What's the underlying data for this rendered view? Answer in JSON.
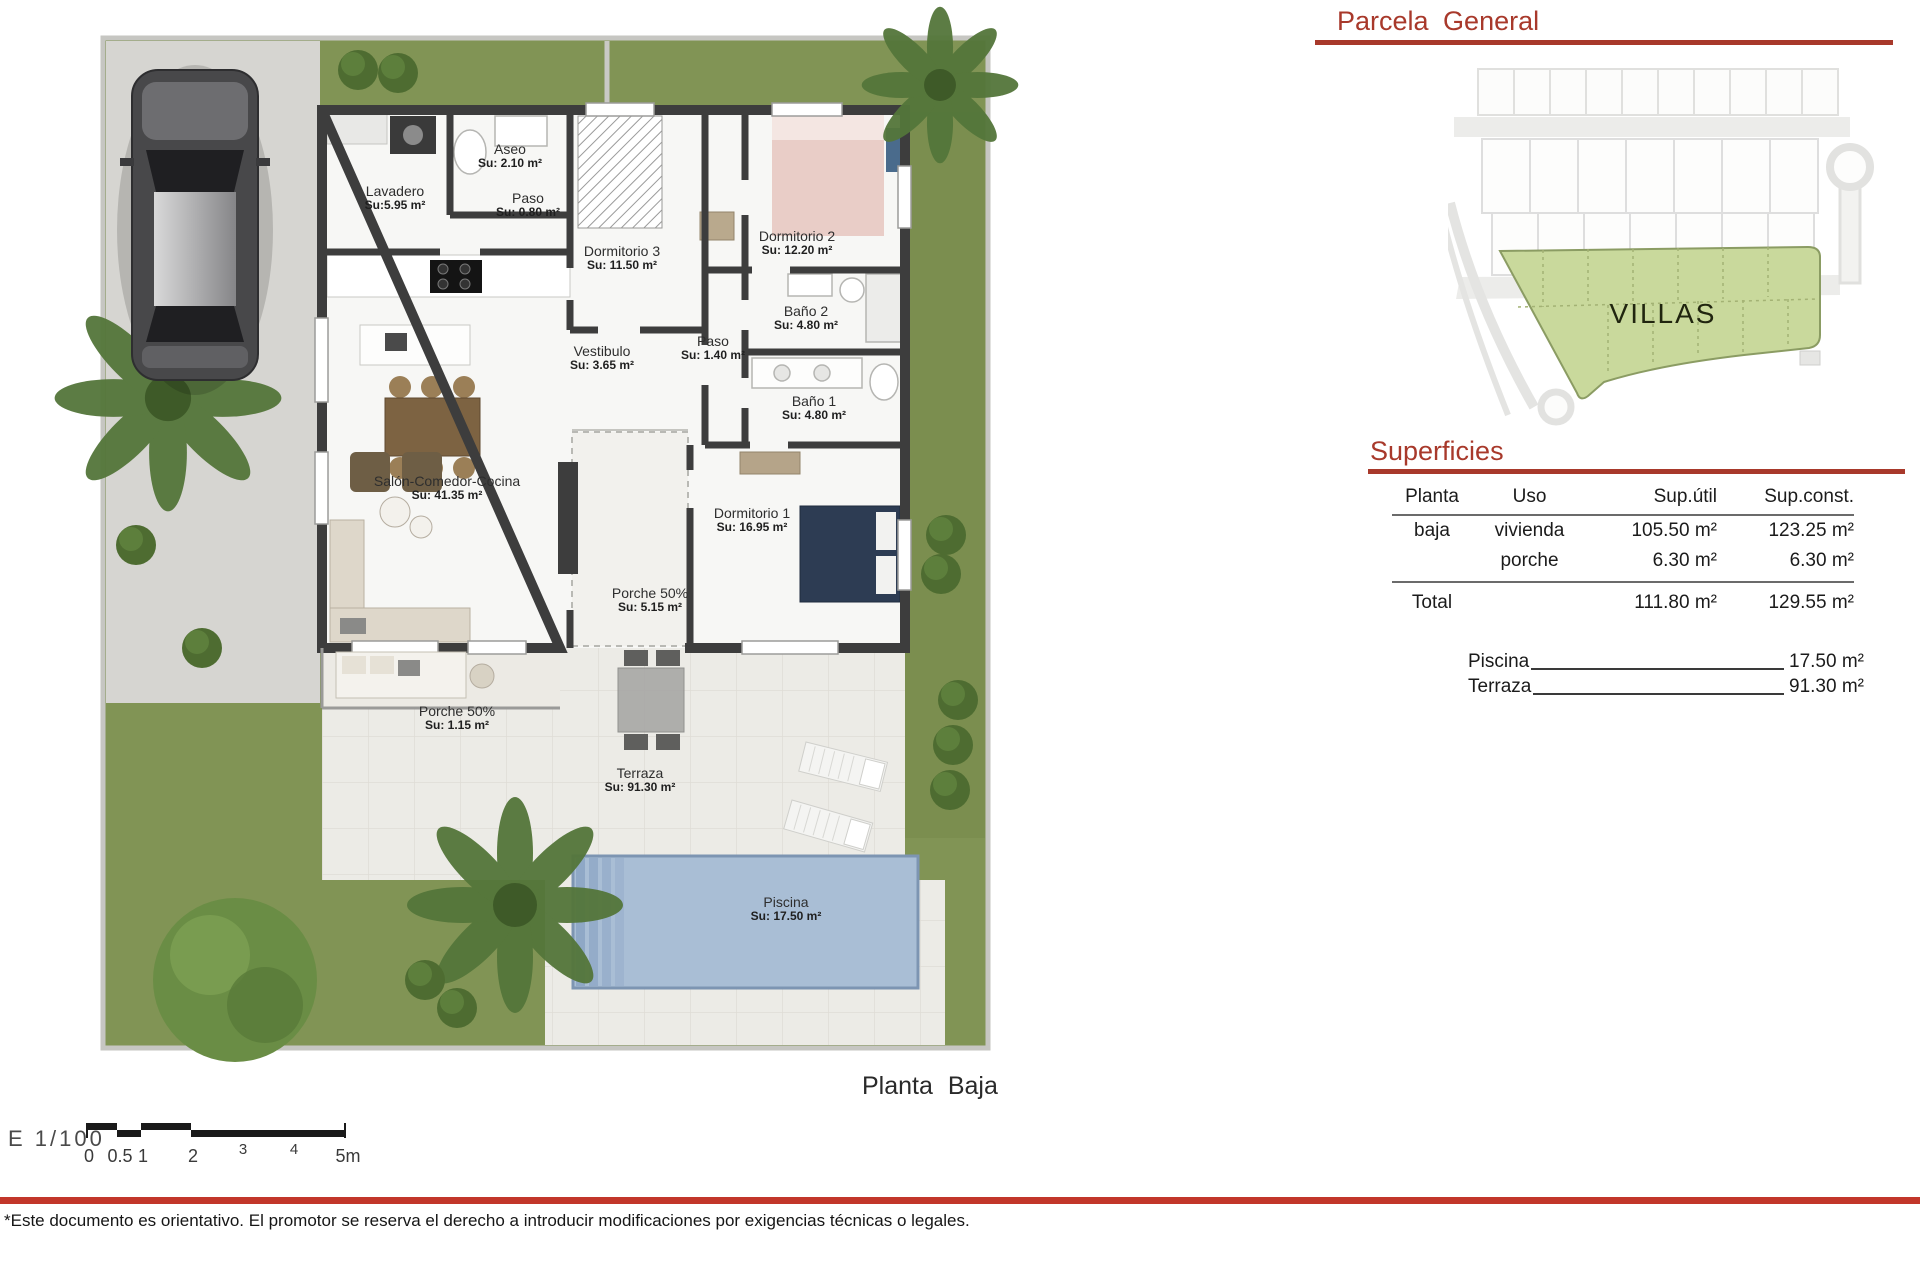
{
  "header": {
    "parcela_title": "Parcela General"
  },
  "siteplan": {
    "villas_label": "VILLAS"
  },
  "superficies": {
    "title": "Superficies",
    "table": {
      "col_planta": "Planta",
      "col_uso": "Uso",
      "col_util": "Sup.útil",
      "col_const": "Sup.const.",
      "rows": [
        {
          "planta": "baja",
          "uso": "vivienda",
          "util": "105.50 m²",
          "const": "123.25 m²"
        },
        {
          "planta": "",
          "uso": "porche",
          "util": "6.30 m²",
          "const": "6.30 m²"
        }
      ],
      "total_label": "Total",
      "total_util": "111.80 m²",
      "total_const": "129.55 m²"
    },
    "extras": [
      {
        "label": "Piscina",
        "value": "17.50 m²"
      },
      {
        "label": "Terraza",
        "value": "91.30 m²"
      }
    ]
  },
  "floorplan": {
    "title": "Planta Baja",
    "rooms": [
      {
        "name": "Aseo",
        "area": "Su: 2.10 m²"
      },
      {
        "name": "Lavadero",
        "area": "Su:5.95 m²"
      },
      {
        "name": "Paso",
        "area": "Su: 0.80 m²"
      },
      {
        "name": "Dormitorio 3",
        "area": "Su: 11.50 m²"
      },
      {
        "name": "Dormitorio 2",
        "area": "Su: 12.20 m²"
      },
      {
        "name": "Baño 2",
        "area": "Su: 4.80 m²"
      },
      {
        "name": "Paso",
        "area": "Su: 1.40 m²"
      },
      {
        "name": "Baño 1",
        "area": "Su: 4.80 m²"
      },
      {
        "name": "Vestibulo",
        "area": "Su: 3.65 m²"
      },
      {
        "name": "Salón-Comedor-Cocina",
        "area": "Su: 41.35 m²"
      },
      {
        "name": "Dormitorio 1",
        "area": "Su: 16.95 m²"
      },
      {
        "name": "Porche 50%",
        "area": "Su: 5.15 m²"
      },
      {
        "name": "Porche 50%",
        "area": "Su: 1.15 m²"
      },
      {
        "name": "Terraza",
        "area": "Su: 91.30 m²"
      },
      {
        "name": "Piscina",
        "area": "Su: 17.50 m²"
      }
    ]
  },
  "scalebar": {
    "label": "E 1/100",
    "ticks": [
      "0",
      "0.5",
      "1",
      "2",
      "3",
      "4",
      "5m"
    ]
  },
  "footer": {
    "disclaimer": "*Este documento es orientativo. El promotor se reserva el derecho a introducir modificaciones por exigencias técnicas o legales."
  }
}
